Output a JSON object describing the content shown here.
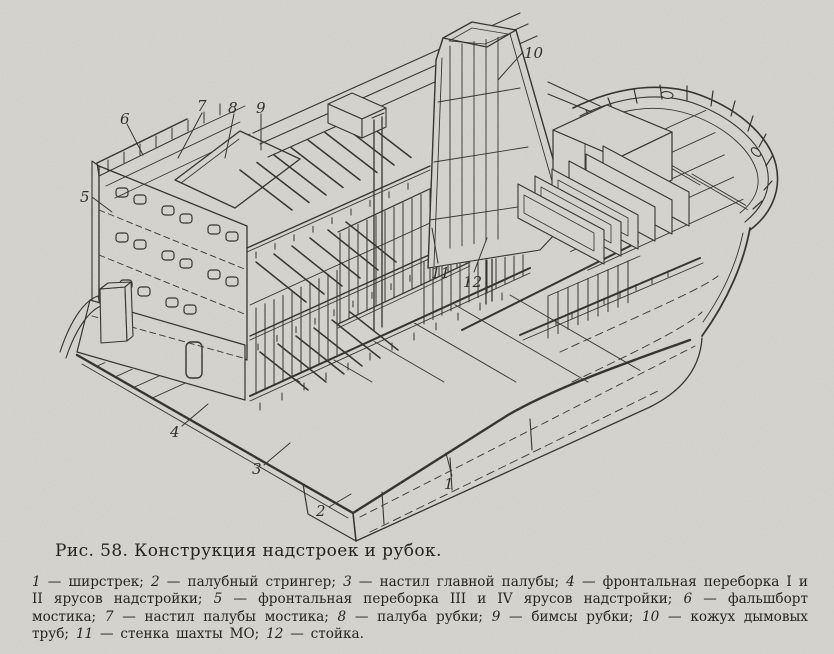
{
  "figure": {
    "caption": "Рис. 58. Конструкция надстроек и рубок.",
    "legend": [
      {
        "num": "1",
        "text": "ширстрек"
      },
      {
        "num": "2",
        "text": "палубный стрингер"
      },
      {
        "num": "3",
        "text": "настил главной палубы"
      },
      {
        "num": "4",
        "text": "фронтальная переборка I и II ярусов надстройки"
      },
      {
        "num": "5",
        "text": "фронтальная переборка III и IV ярусов надстройки"
      },
      {
        "num": "6",
        "text": "фальшборт мостика"
      },
      {
        "num": "7",
        "text": "настил палубы мостика"
      },
      {
        "num": "8",
        "text": "палуба рубки"
      },
      {
        "num": "9",
        "text": "бимсы рубки"
      },
      {
        "num": "10",
        "text": "кожух дымовых труб"
      },
      {
        "num": "11",
        "text": "стенка шахты МО"
      },
      {
        "num": "12",
        "text": "стойка"
      }
    ]
  },
  "colors": {
    "paper": "#d7d5d0",
    "ink": "#2d2b27"
  }
}
